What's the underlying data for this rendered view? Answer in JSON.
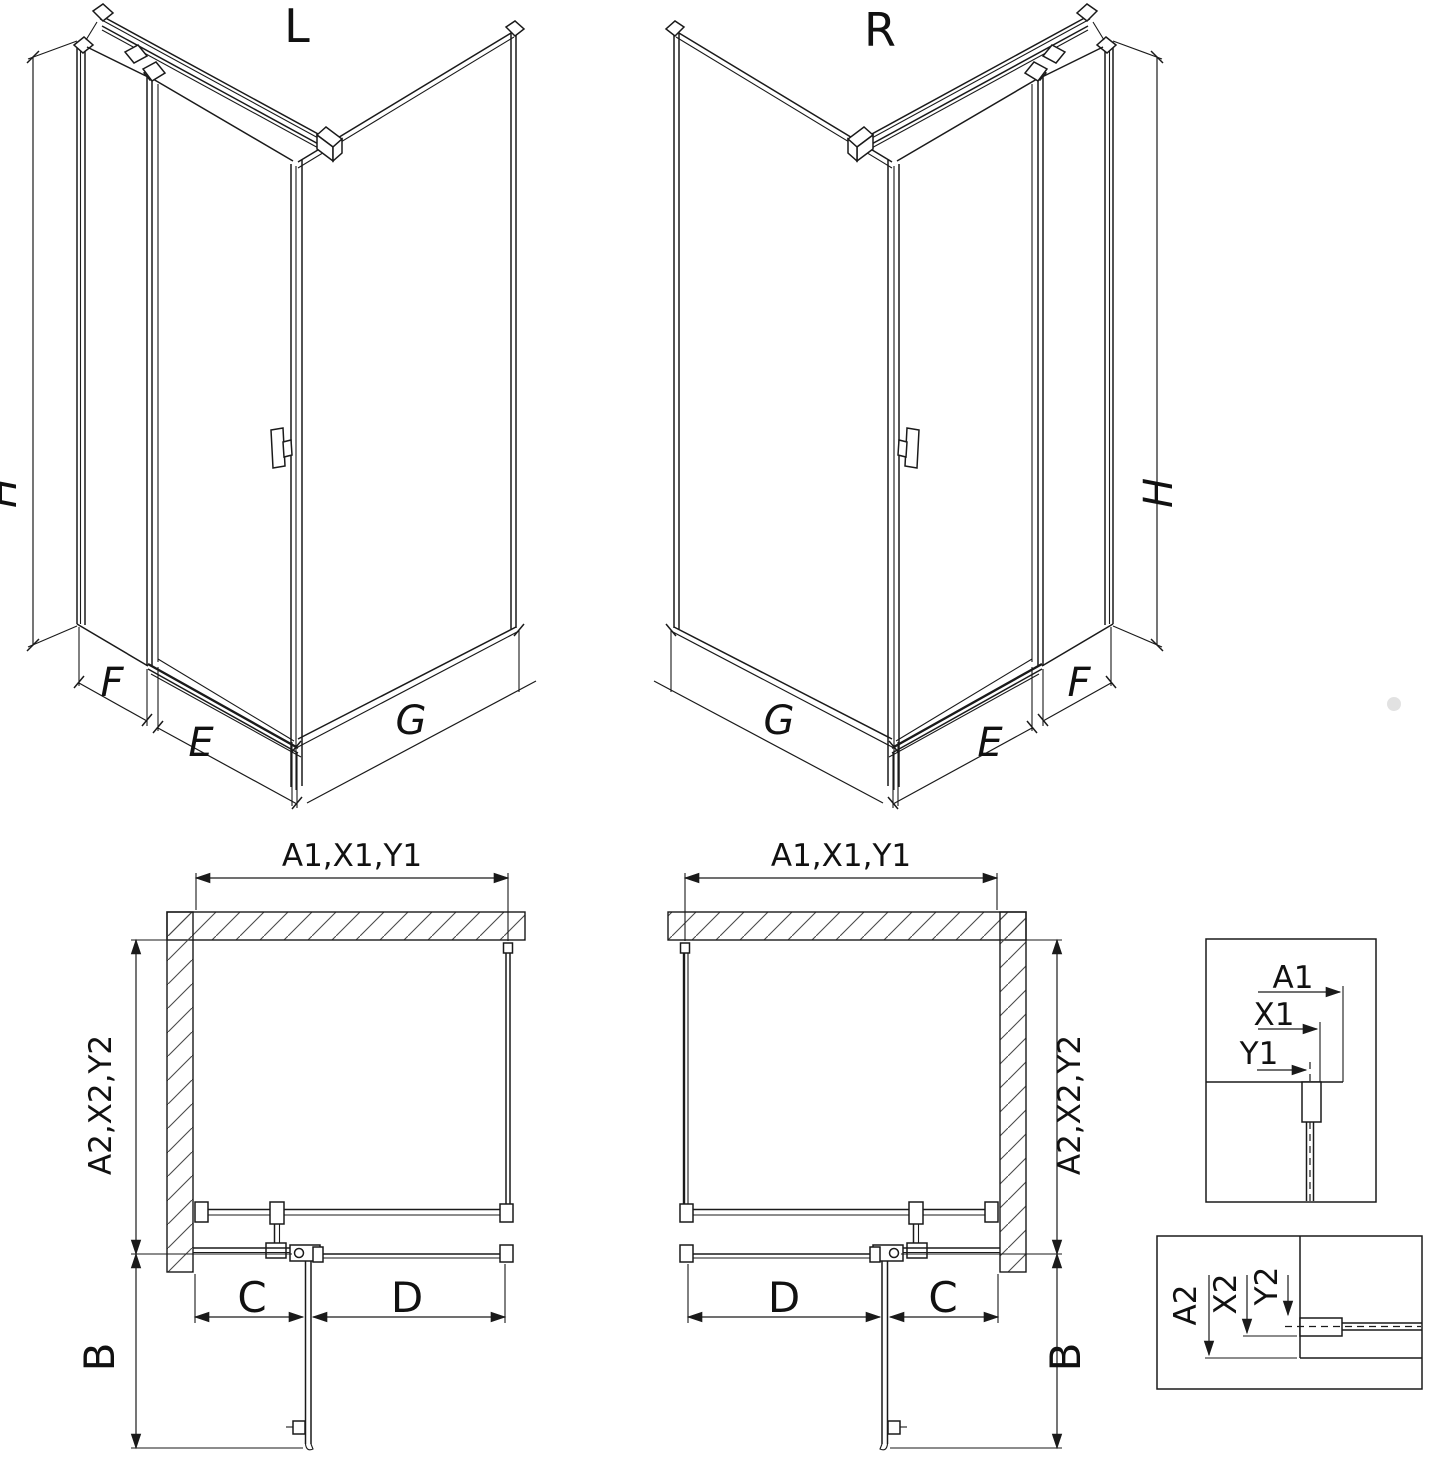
{
  "drawing": {
    "title_left": "L",
    "title_right": "R",
    "iso_dims": {
      "height": "H",
      "side_panel": "F",
      "door": "E",
      "return_panel": "G"
    },
    "plan": {
      "top_dim": "A1,X1,Y1",
      "side_dim": "A2,X2,Y2",
      "entry": "B",
      "fixed_segment": "C",
      "door_segment": "D"
    },
    "detail_top": {
      "a1": "A1",
      "x1": "X1",
      "y1": "Y1"
    },
    "detail_bottom": {
      "a2": "A2",
      "x2": "X2",
      "y2": "Y2"
    },
    "colors": {
      "line": "#1a1a1a",
      "background": "#ffffff",
      "watermark": "#d2d2d2"
    }
  }
}
